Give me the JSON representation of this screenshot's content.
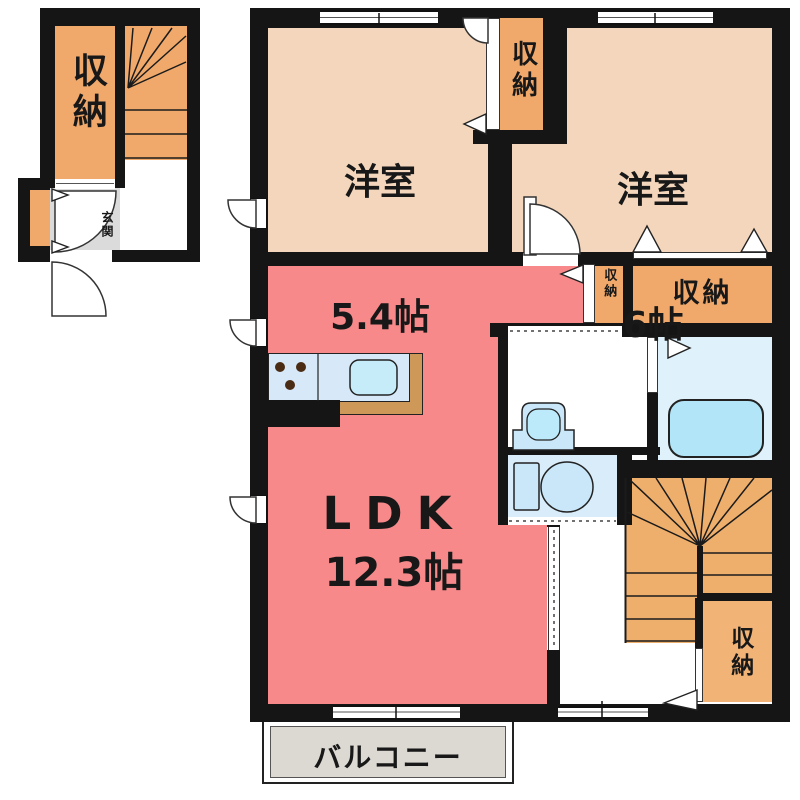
{
  "annex": {
    "storage_label": "収納",
    "entrance_label": "玄関"
  },
  "rooms": {
    "western1_name": "洋室",
    "western1_size": "5.4帖",
    "western2_name": "洋室",
    "western2_size": "6帖",
    "ldk_name": "LDK",
    "ldk_size": "12.3帖",
    "balcony_label": "バルコニー",
    "storage_mid_label": "収納",
    "storage_narrow_label": "収納",
    "storage_wide_label": "収納",
    "storage_bottom_right_label": "収納"
  },
  "palette": {
    "wall": "#151515",
    "room_peach": "#F3D6BB",
    "storage_orange": "#F0A96B",
    "ldk_red": "#F8898B",
    "kitchen_counter": "#D7E9F8",
    "kitchen_sink": "#C6ECFA",
    "kitchen_base_tan": "#CE9859",
    "bathroom_floor": "#DFF1FA",
    "toilet_room": "#D8ECF9",
    "fixture_blue": "#C9E7F8",
    "bathtub_blue": "#B1E5F7",
    "entrance_gray": "#DBDBDB",
    "balcony_gray": "#DCD8D2"
  }
}
